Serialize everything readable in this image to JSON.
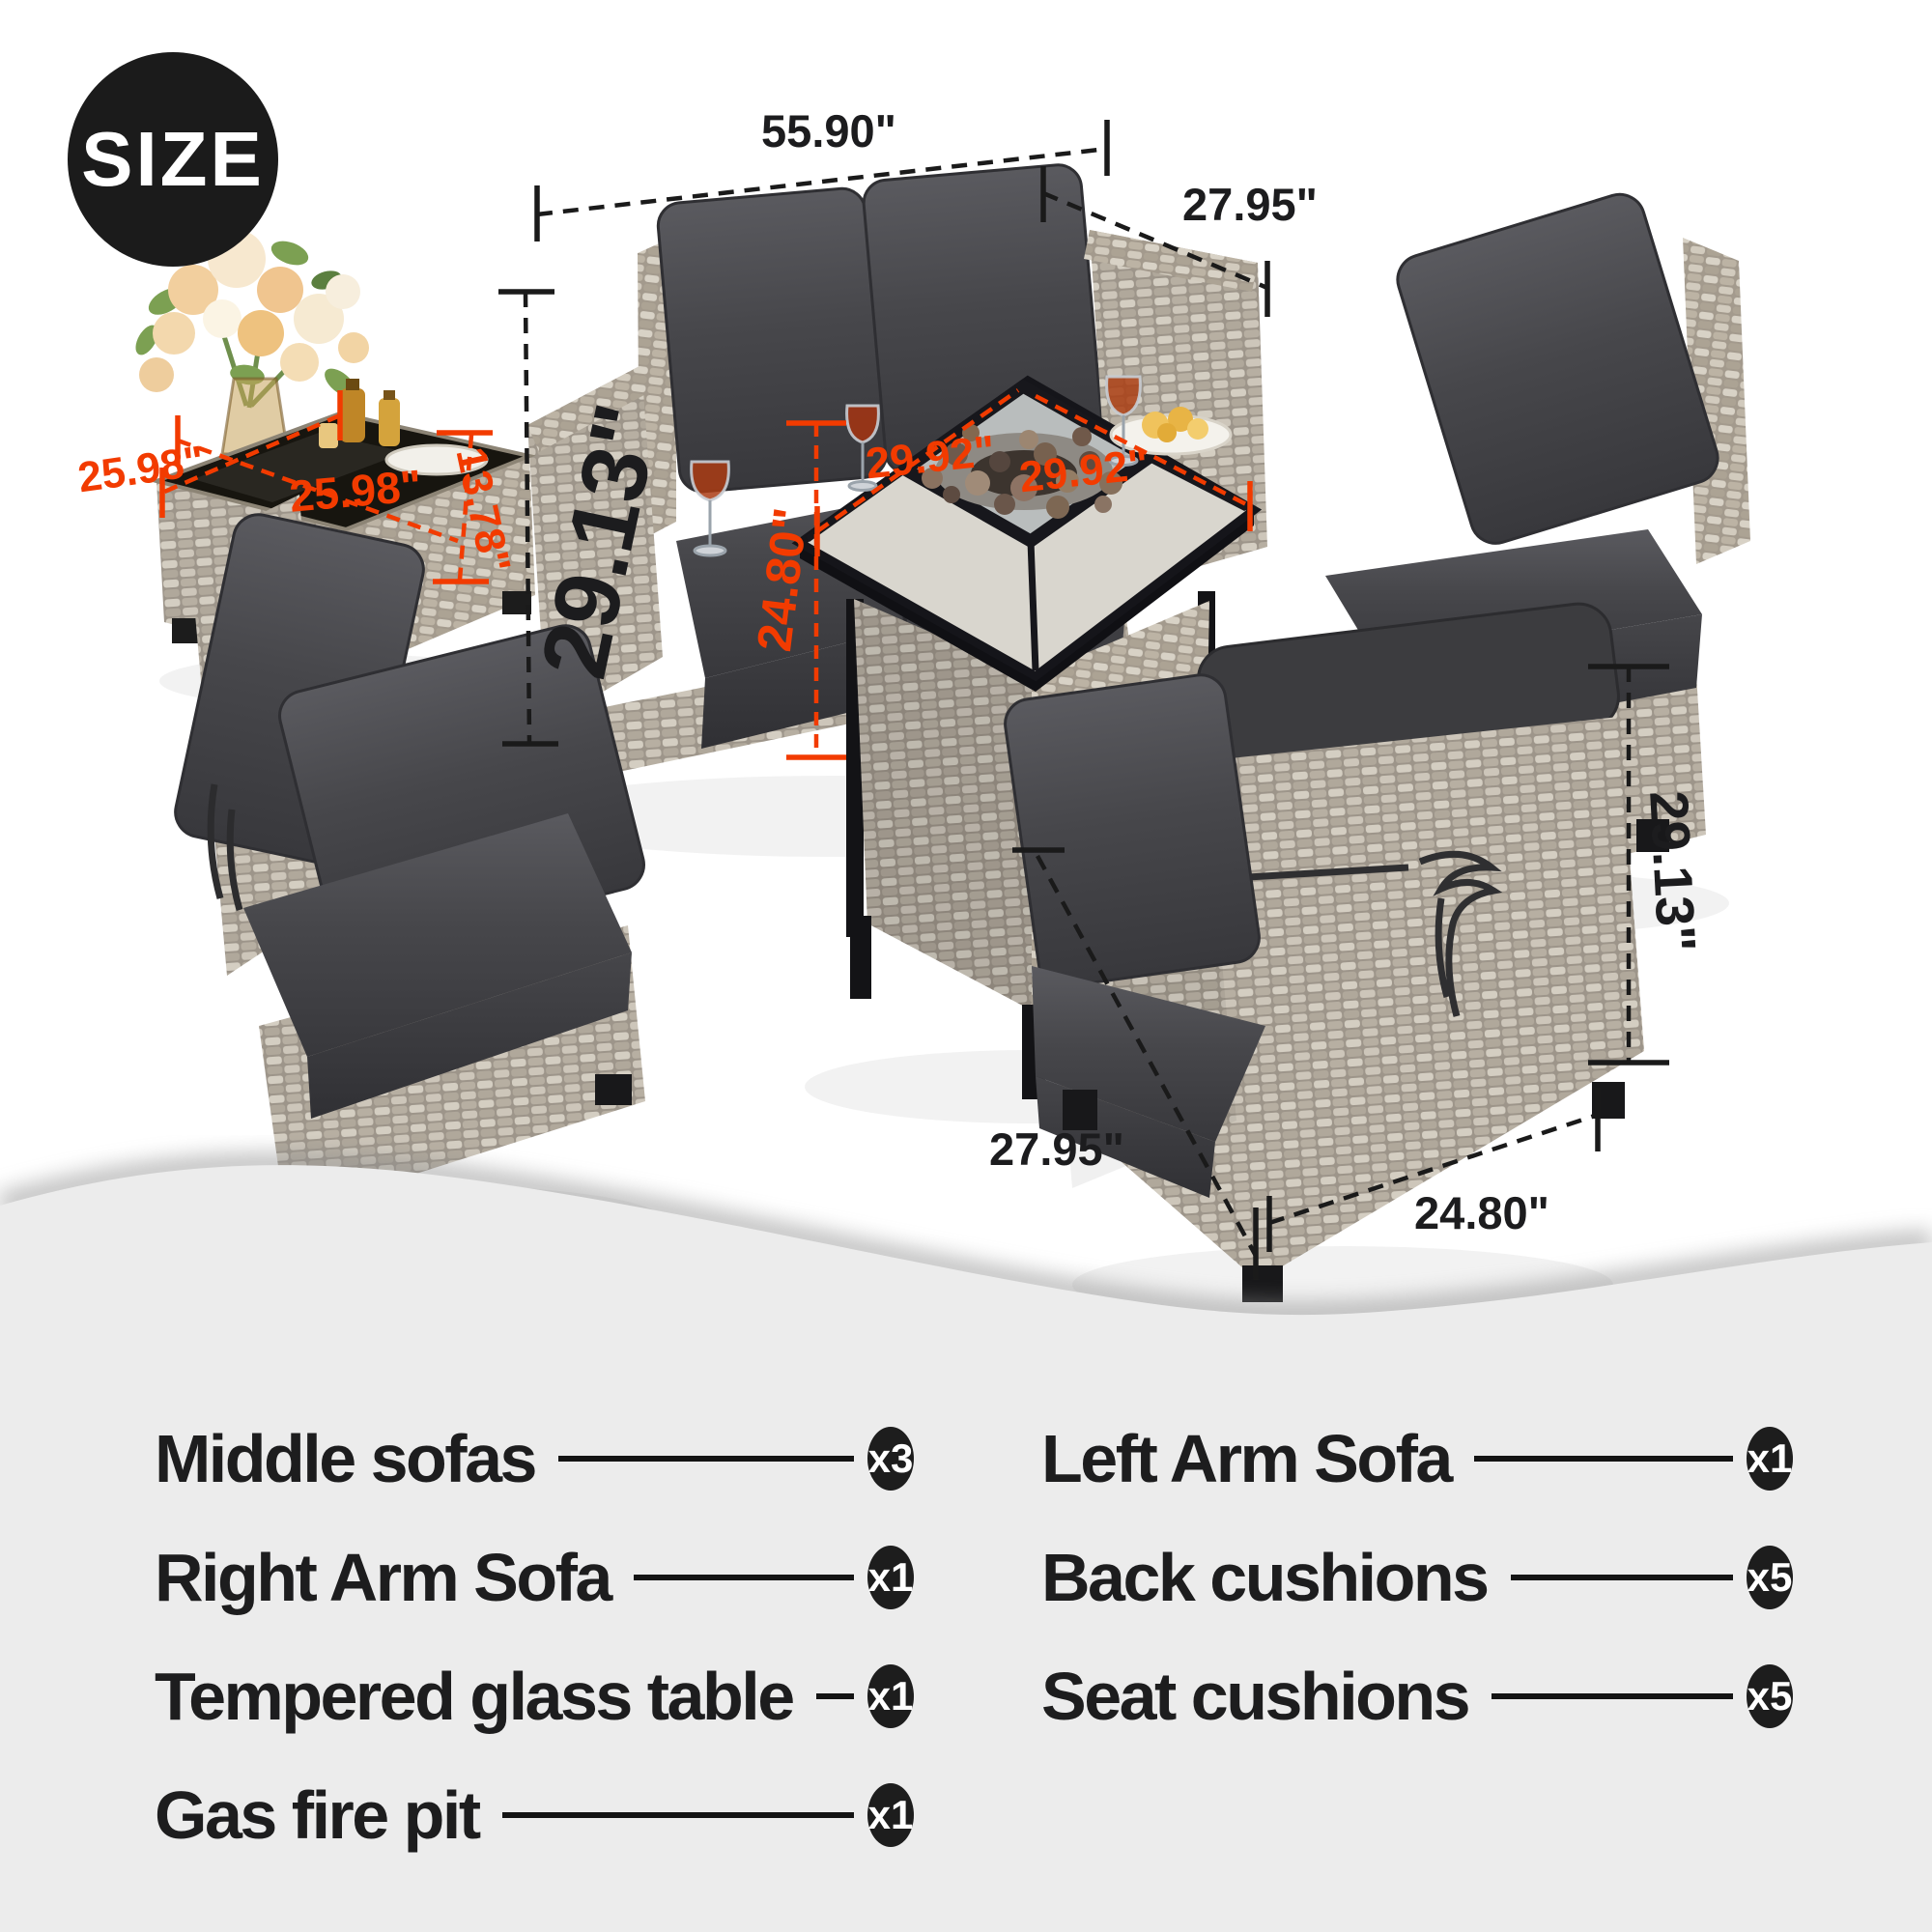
{
  "size_badge": "SIZE",
  "dims": {
    "sofa_width": "55.90\"",
    "sofa_depth": "27.95\"",
    "sofa_height": "29.13\"",
    "side_table_width": "25.98\"",
    "side_table_depth": "25.98\"",
    "side_table_height": "13.78\"",
    "fire_pit_width": "29.92\"",
    "fire_pit_depth": "29.92\"",
    "fire_pit_height": "24.80\"",
    "chair_height": "29.13\"",
    "chair_width": "27.95\"",
    "chair_depth": "24.80\""
  },
  "list": {
    "left": [
      {
        "label": "Middle sofas",
        "count": "x3"
      },
      {
        "label": "Right Arm Sofa",
        "count": "x1"
      },
      {
        "label": "Tempered glass table",
        "count": "x1"
      },
      {
        "label": "Gas fire pit",
        "count": "x1"
      }
    ],
    "right": [
      {
        "label": "Left Arm Sofa",
        "count": "x1"
      },
      {
        "label": "Back cushions",
        "count": "x5"
      },
      {
        "label": "Seat cushions",
        "count": "x5"
      }
    ]
  },
  "colors": {
    "accent_orange": "#f23b00",
    "ink": "#1c1c1e",
    "badge_black": "#1d1d1d",
    "panel_gray": "#ececec",
    "wicker_light": "#d4cec2",
    "wicker_dark": "#9d958a",
    "cushion_gray": "#47474b"
  }
}
